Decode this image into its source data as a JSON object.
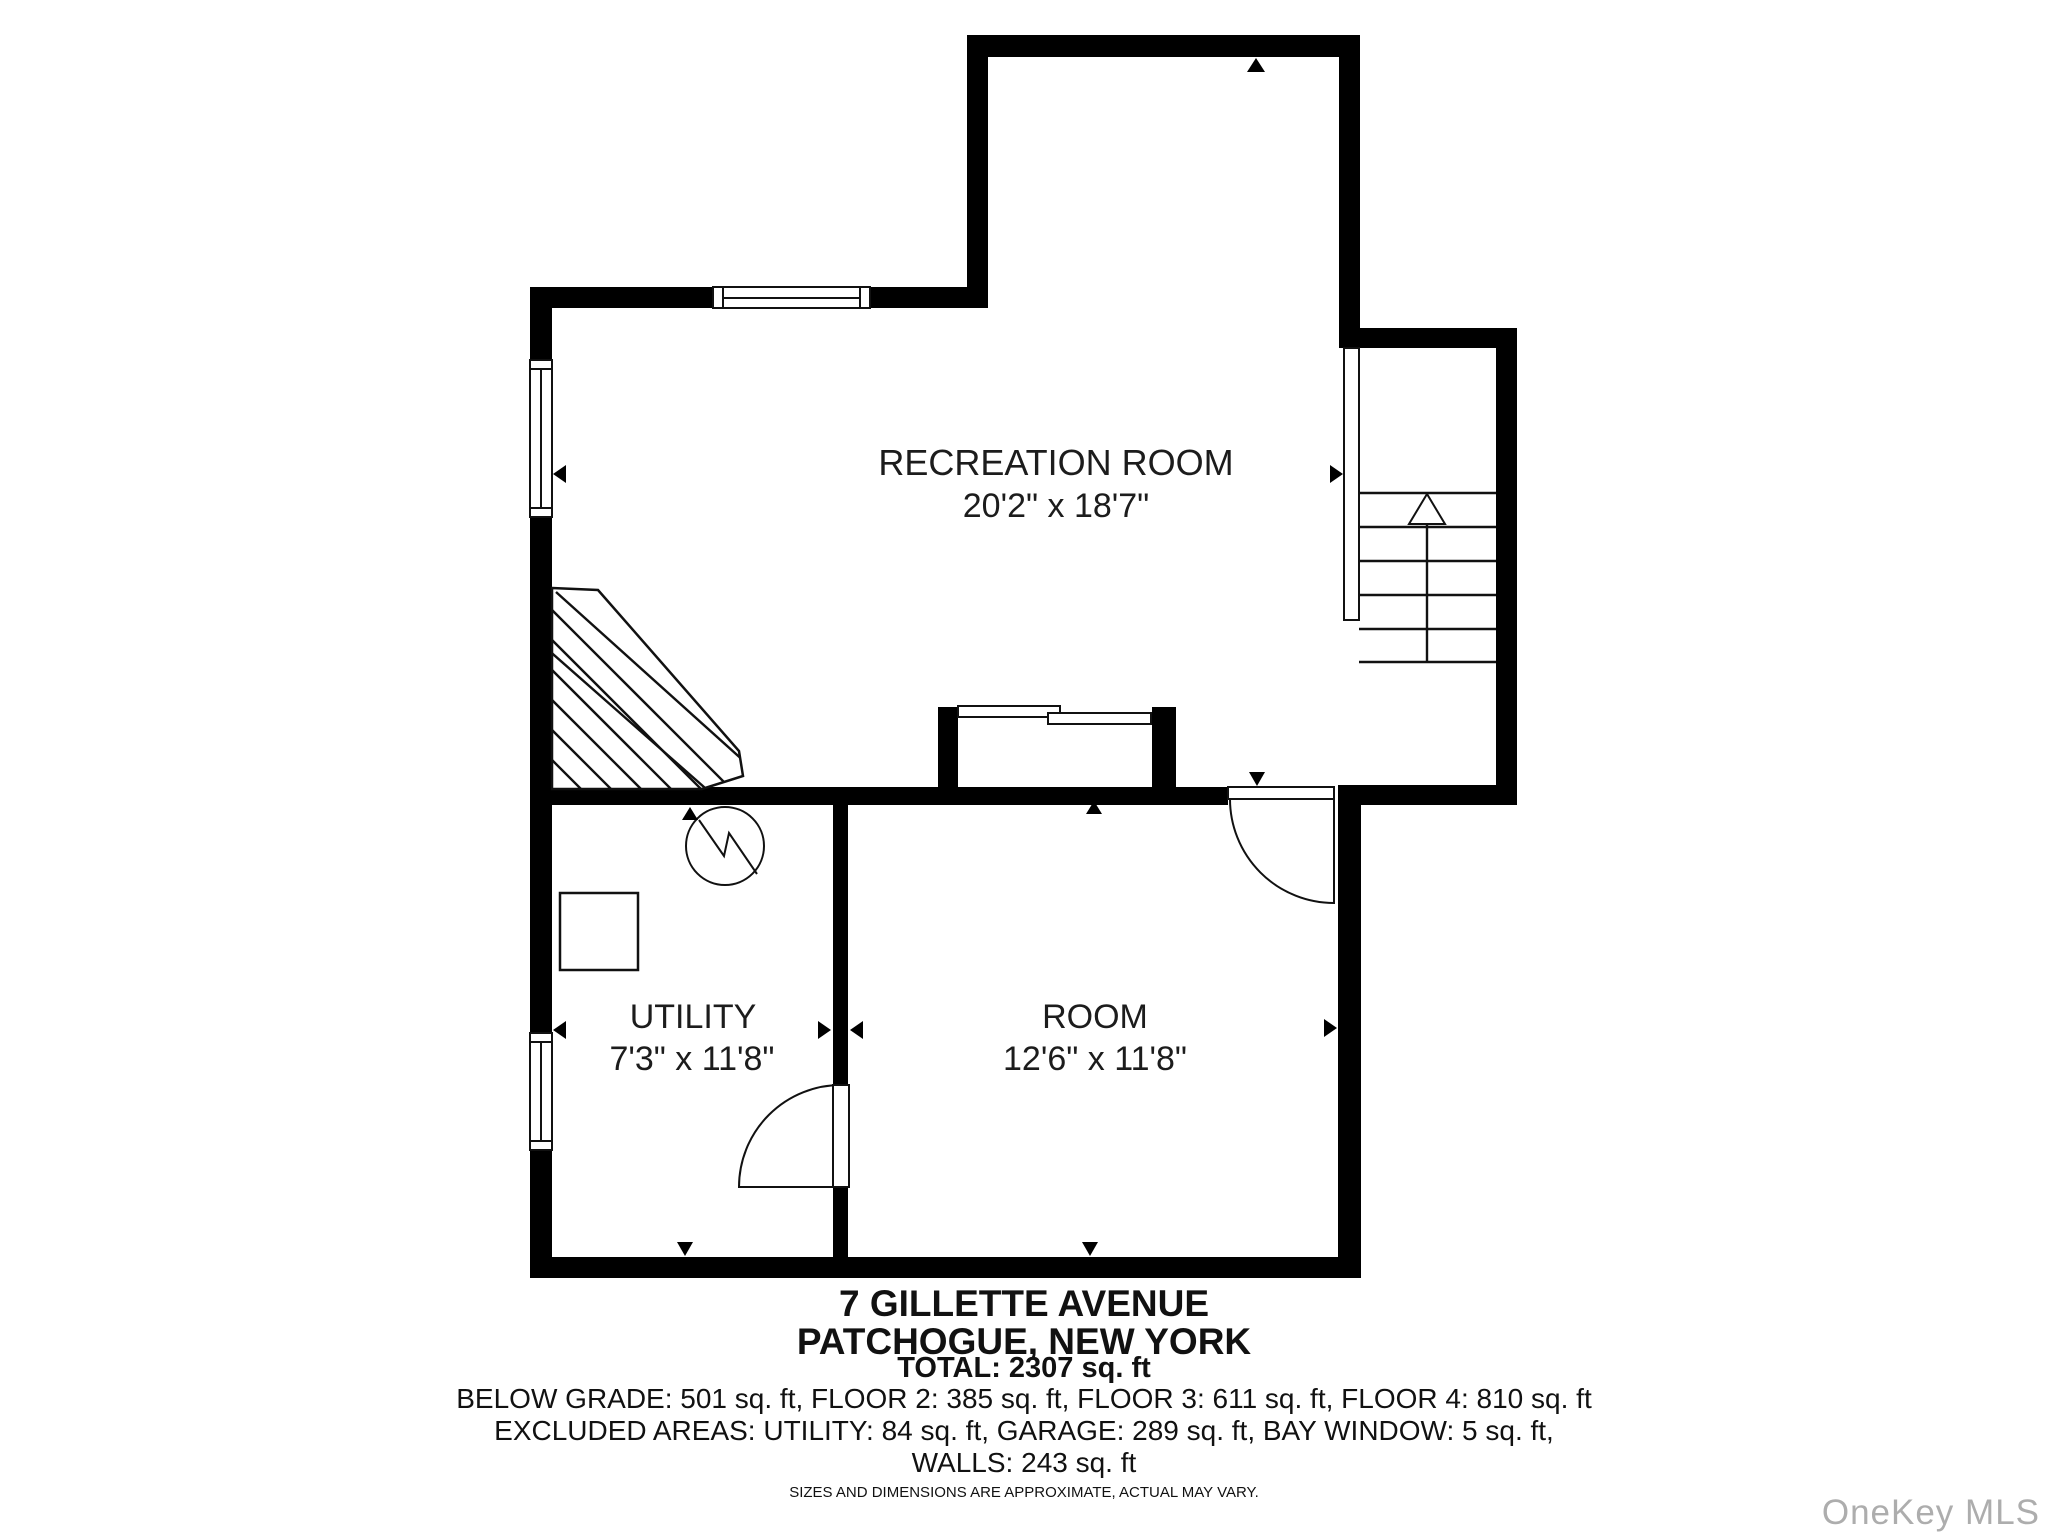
{
  "colors": {
    "wall": "#000000",
    "line": "#111111",
    "text": "#1c1c1c",
    "footer_text": "#111111",
    "watermark": "#adadad",
    "background": "#ffffff"
  },
  "plan": {
    "rooms": [
      {
        "label": "RECREATION ROOM",
        "dims": "20'2\" x 18'7\""
      },
      {
        "label": "UTILITY",
        "dims": "7'3\" x 11'8\""
      },
      {
        "label": "ROOM",
        "dims": "12'6\" x 11'8\""
      }
    ],
    "icons": {
      "stairs_up_arrow": "up-arrow",
      "electrical_panel": "circle-with-lightning-bolt",
      "door_swing": "quarter-circle-arc",
      "window": "double-line-in-wall",
      "dimension_marker": "small-filled-triangle"
    }
  },
  "footer": {
    "address_line1": "7 GILLETTE AVENUE",
    "address_line2": "PATCHOGUE, NEW YORK",
    "total": "TOTAL: 2307 sq. ft",
    "floor_areas": "BELOW GRADE: 501 sq. ft, FLOOR 2: 385 sq. ft, FLOOR 3: 611 sq. ft, FLOOR 4: 810 sq. ft",
    "excluded_areas": "EXCLUDED AREAS: UTILITY: 84 sq. ft, GARAGE: 289 sq. ft, BAY WINDOW: 5 sq. ft,",
    "walls_area": "WALLS: 243 sq. ft",
    "disclaimer": "SIZES AND DIMENSIONS ARE APPROXIMATE, ACTUAL MAY VARY."
  },
  "watermark": "OneKey MLS"
}
